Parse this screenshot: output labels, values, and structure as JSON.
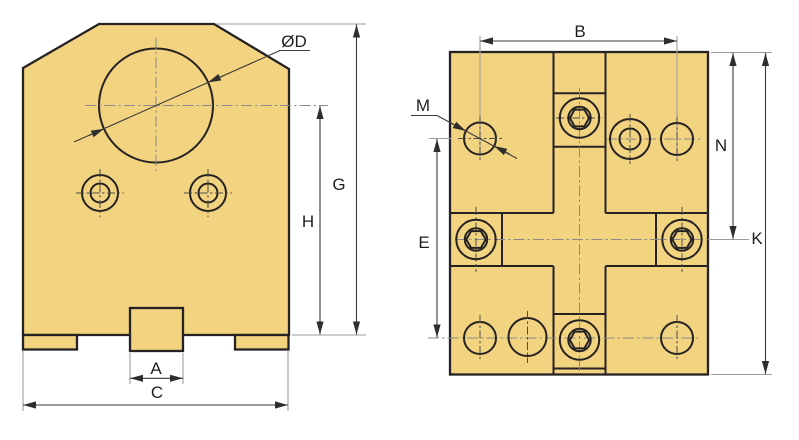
{
  "drawing": {
    "kind": "engineering-drawing-two-views",
    "front_view": {
      "labels": {
        "bore_diameter": "ØD",
        "overall_height": "G",
        "bore_center_height": "H",
        "key_width": "A",
        "overall_width": "C"
      }
    },
    "side_view": {
      "labels": {
        "hole_span": "B",
        "hole_diameter": "M",
        "top_edge_to_center": "N",
        "overall_height": "K",
        "hole_rows_spacing": "E"
      }
    },
    "colors": {
      "background": "#ffffff",
      "part_fill": "#F2D37F",
      "edge": "#262223",
      "dimension": "#3a3a3a",
      "extension": "#9e9e9e",
      "centerline": "#8a8a8a",
      "crosshair": "#4d4d4d",
      "label_text": "#1f1f1f"
    }
  }
}
